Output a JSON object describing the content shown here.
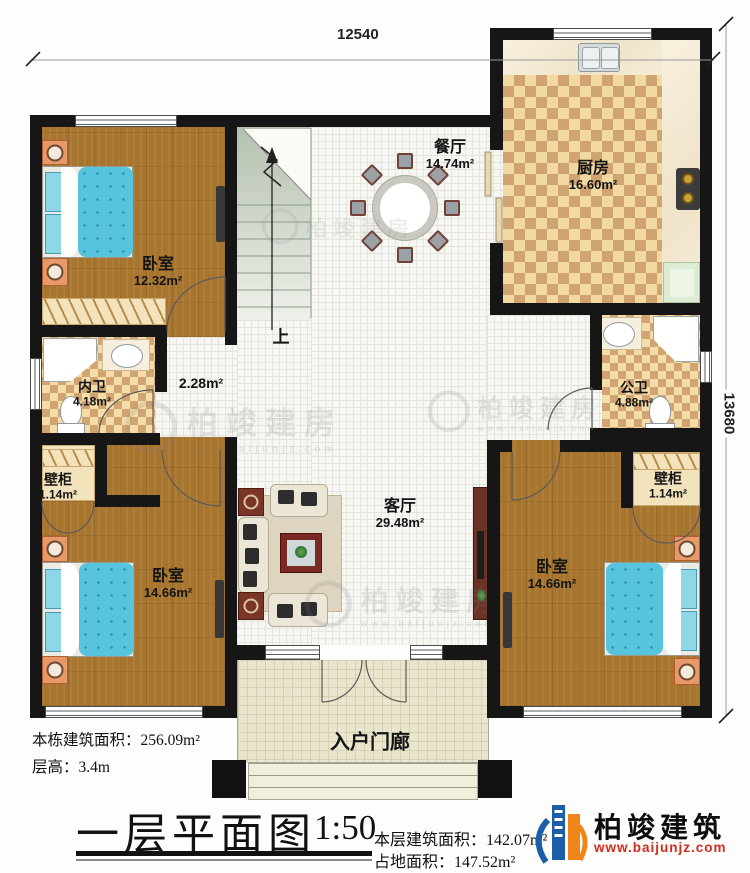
{
  "dimensions": {
    "width": "12540",
    "height": "13680"
  },
  "rooms": {
    "bedroom_tl": {
      "name": "卧室",
      "area": "12.32m²"
    },
    "bedroom_bl": {
      "name": "卧室",
      "area": "14.66m²"
    },
    "bedroom_br": {
      "name": "卧室",
      "area": "14.66m²"
    },
    "dining": {
      "name": "餐厅",
      "area": "14.74m²"
    },
    "kitchen": {
      "name": "厨房",
      "area": "16.60m²"
    },
    "bath_inner": {
      "name": "内卫",
      "area": "4.18m²"
    },
    "bath_public": {
      "name": "公卫",
      "area": "4.88m²"
    },
    "closet_left": {
      "name": "壁柜",
      "area": "1.14m²"
    },
    "closet_right": {
      "name": "壁柜",
      "area": "1.14m²"
    },
    "living": {
      "name": "客厅",
      "area": "29.48m²"
    },
    "hall": {
      "area": "2.28m²"
    },
    "porch": {
      "name": "入户门廊"
    },
    "stairs": {
      "up_label": "上"
    }
  },
  "notes": {
    "total_area_label": "本栋建筑面积：",
    "total_area_value": "256.09m²",
    "floor_height_label": "层高：",
    "floor_height_value": "3.4m"
  },
  "title_block": {
    "title": "一层平面图",
    "scale": "1:50",
    "floor_area_label": "本层建筑面积：",
    "floor_area_value": "142.07m²",
    "land_area_label": "占地面积：",
    "land_area_value": "147.52m²"
  },
  "brand": {
    "name": "柏竣建筑",
    "website": "www.baijunjz.com"
  },
  "watermark": {
    "text": "柏竣建房",
    "site": "www.baijunjz.com"
  },
  "colors": {
    "wall": "#161616",
    "wood": "#a8752f",
    "check_dark": "#cfa470",
    "check_light": "#f2d9a2",
    "bed": "#58c3dc",
    "brand_blue": "#1c5fa8",
    "brand_orange": "#f08519",
    "brand_red": "#d42a1d"
  }
}
